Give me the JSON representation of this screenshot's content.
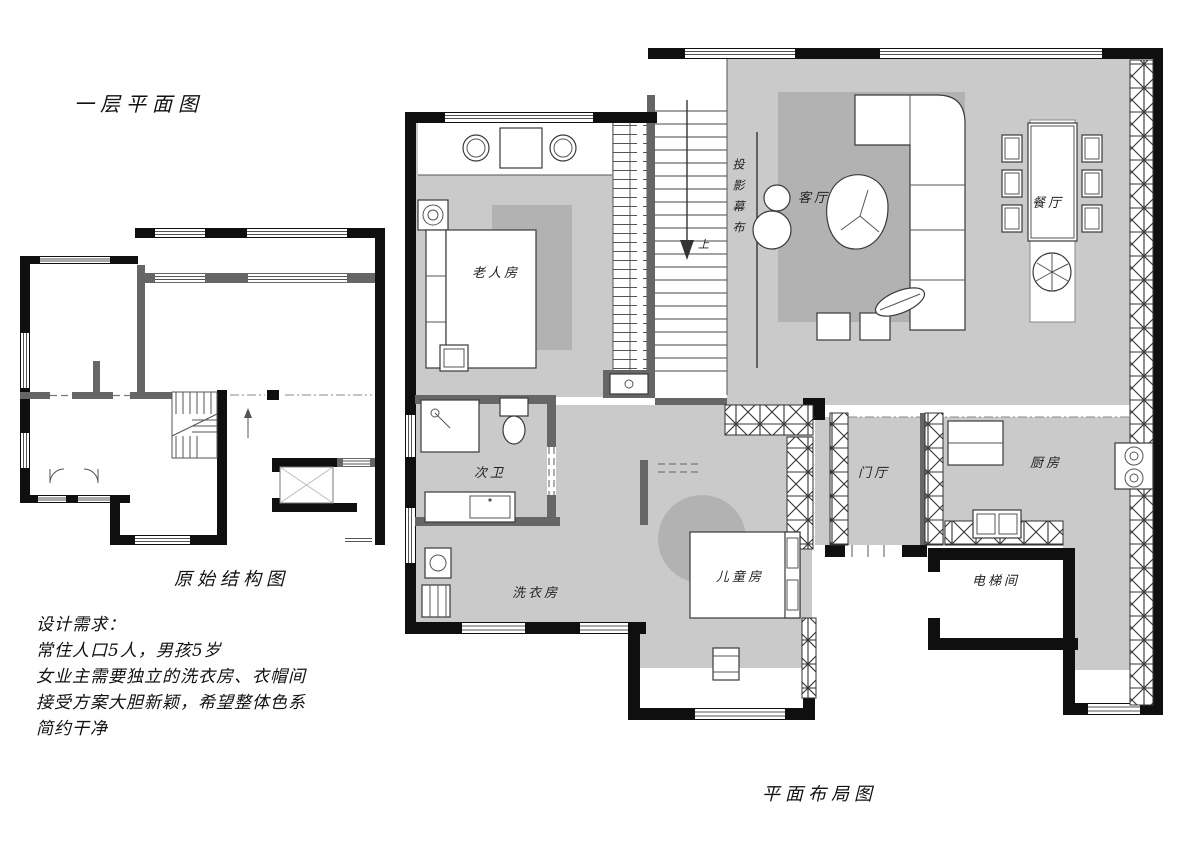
{
  "page": {
    "title": "一层平面图",
    "small_plan_caption": "原始结构图",
    "large_plan_caption": "平面布局图"
  },
  "requirements": {
    "heading": "设计需求：",
    "lines": [
      "常住人口5人，男孩5岁",
      "女业主需要独立的洗衣房、衣帽间",
      "接受方案大胆新颖，希望整体色系",
      "简约干净"
    ]
  },
  "rooms": {
    "elder_bedroom": "老人房",
    "projection_screen": "投影幕布",
    "living_room": "客厅",
    "dining_room": "餐厅",
    "second_bathroom": "次卫",
    "laundry_room": "洗衣房",
    "kids_room": "儿童房",
    "foyer": "门厅",
    "kitchen": "厨房",
    "elevator_room": "电梯间",
    "stairs_up": "上"
  },
  "colors": {
    "exterior_wall": "#0f0f0f",
    "interior_wall": "#666666",
    "floor": "#cacaca",
    "rug": "#b2b2b2",
    "background": "#ffffff",
    "line": "#3a3a3a"
  }
}
